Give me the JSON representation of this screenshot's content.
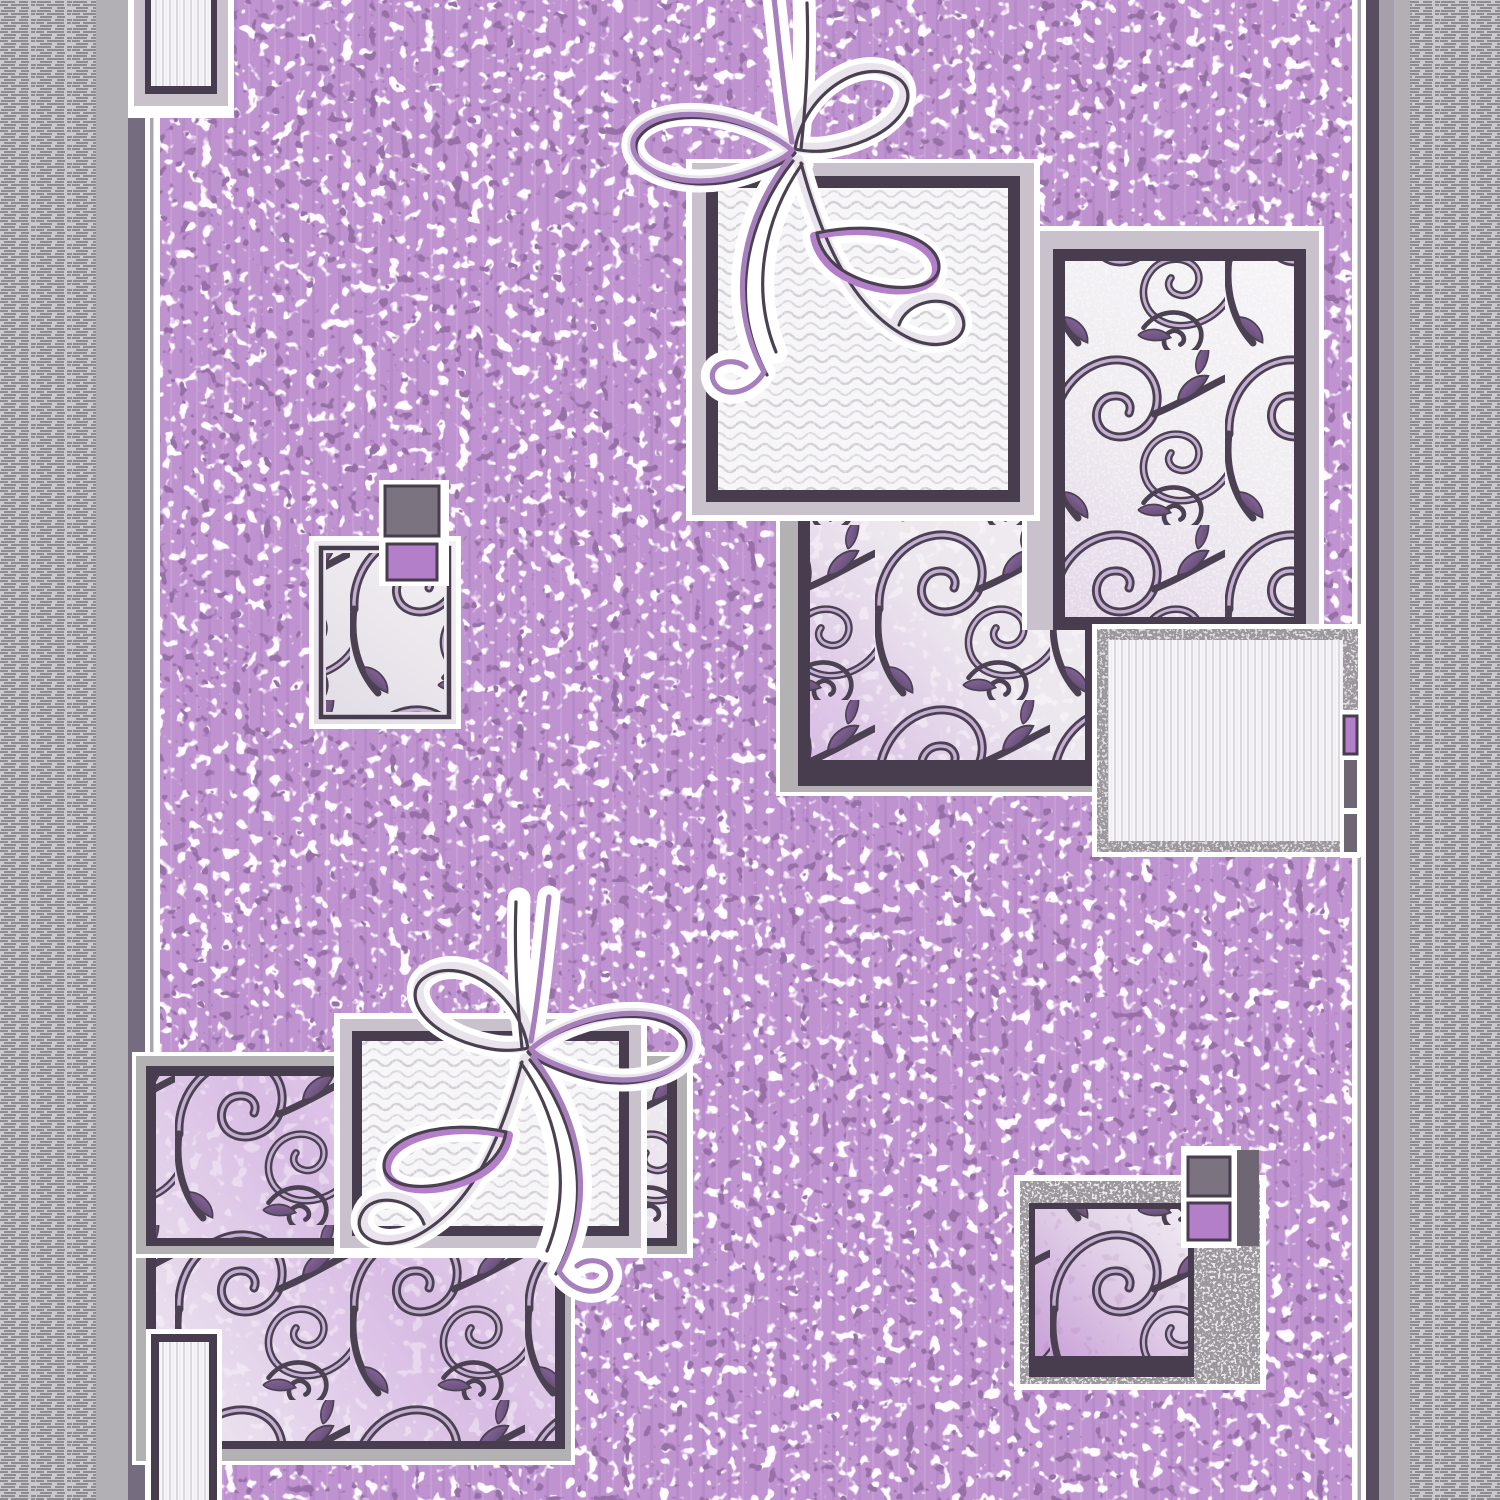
{
  "artwork": {
    "kind": "woven carpet runner pattern (photo/scan, no text)",
    "orientation": "vertical",
    "palette": {
      "lilac_base": "#bf92d0",
      "fleck_light": "#f6f0f8",
      "fleck_dark": "#4f2a63",
      "border_tex_bg": "#cac8cb",
      "border_tex_dash": "#8f8c91",
      "border_plain": "#b3b0b5",
      "stripe_left": "#756c80",
      "stripe_dark": "#584e60",
      "stripe_lavender": "#a89fad",
      "thin_line": "#a9a4ad",
      "white": "#ffffff",
      "frame_light": "#c9c2cd",
      "frame_gray": "#b4b1b5",
      "frame_silver": "#9b979d",
      "frame_dark": "#473d4e",
      "vine_stroke": "#4b4153",
      "vine_highlight": "#c4aed2",
      "leaf_purple": "#9268aa",
      "scroll_bg_light": "#f0edf1",
      "scroll_bg_lilac": "#d8bce4",
      "zig_bg": "#f6f5f7",
      "zig_line": "#d4d0d6",
      "stripe_line": "#dcd8de",
      "accent_gray": "#7b7380",
      "accent_purple": "#b37fc8",
      "tab_dark": "#6e6673",
      "ribbon_body": "#e9e3ec",
      "ribbon_purple": "#a77fbc",
      "ribbon_dark": "#4a4150"
    },
    "components": [
      {
        "name": "left-border",
        "desc": "gray selvedge band with horizontal dash weave and inner purple-gray stripe"
      },
      {
        "name": "right-border",
        "desc": "gray selvedge band with dash weave, lavender and dark stripes"
      },
      {
        "name": "purple-field",
        "desc": "lilac ground mottled with white and dark-purple flecks"
      },
      {
        "name": "top-left-striped-square",
        "desc": "partial white square with vertical pinstripes and dark frame, clipped by top edge"
      },
      {
        "name": "top-zigzag-square",
        "desc": "white square filled with chevron waves, lavender and dark purple frames"
      },
      {
        "name": "ribbon-knot-top",
        "desc": "calligraphic ribbon bow with loops and tails draped over the top zigzag square"
      },
      {
        "name": "top-right-scroll-square",
        "desc": "large square of curling vine scrolls with leaves on pale ground"
      },
      {
        "name": "middle-scroll-square",
        "desc": "vine scroll square on lilac-washed ground below the zigzag square"
      },
      {
        "name": "right-striped-square",
        "desc": "white vertically striped square with silver frame and small purple/gray tabs on its right edge"
      },
      {
        "name": "mid-left-small-square",
        "desc": "small scroll-filled rectangle with stacked gray and purple accent squares on top"
      },
      {
        "name": "bottom-left-scroll-panel",
        "desc": "large stepped panel of vine scrolls with dark frame"
      },
      {
        "name": "bottom-zigzag-square",
        "desc": "white chevron-wave square overlapping the scroll panel"
      },
      {
        "name": "ribbon-knot-bottom",
        "desc": "mirrored ribbon bow motif over the bottom zigzag square"
      },
      {
        "name": "bottom-left-striped-band",
        "desc": "narrow white pinstriped box running to the bottom edge"
      },
      {
        "name": "bottom-right-scroll-square",
        "desc": "small scroll square in silver mottled frame with stacked gray and purple tabs"
      }
    ]
  }
}
